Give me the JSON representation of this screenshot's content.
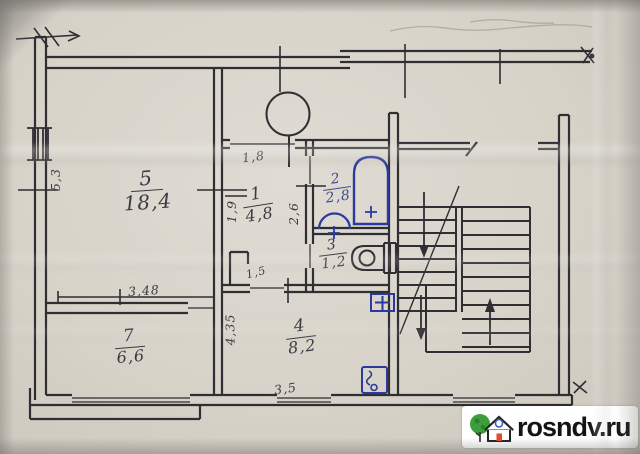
{
  "plan_title": "apartment floor plan (hand-drawn)",
  "rooms": [
    {
      "id": "living",
      "num": "5",
      "area": "18,4"
    },
    {
      "id": "hall",
      "num": "1",
      "area": "4,8"
    },
    {
      "id": "bath",
      "num": "2",
      "area": "2,8"
    },
    {
      "id": "wc",
      "num": "3",
      "area": "1,2"
    },
    {
      "id": "kitchen",
      "num": "4",
      "area": "8,2"
    },
    {
      "id": "bedroom",
      "num": "7",
      "area": "6,6"
    }
  ],
  "dims": [
    {
      "id": "left-height",
      "text": "5,3"
    },
    {
      "id": "bedroom-width",
      "text": "3,48"
    },
    {
      "id": "hall-door",
      "text": "1,8"
    },
    {
      "id": "hall-width",
      "text": "1,9"
    },
    {
      "id": "hall-depth",
      "text": "2,6"
    },
    {
      "id": "closet-width",
      "text": "1,5"
    },
    {
      "id": "kitchen-height",
      "text": "4,35"
    },
    {
      "id": "kitchen-width",
      "text": "3,5"
    }
  ],
  "watermark": {
    "text": "rosndv.ru"
  },
  "icons": {
    "bathtub": "bathtub-icon",
    "sink": "sink-icon",
    "toilet": "toilet-icon",
    "vent": "vent-shaft-icon",
    "stove": "electric-stove-icon",
    "cross_box": "plus-box-icon",
    "stairs": "staircase",
    "watermark_logo": "house-logo-icon"
  },
  "colors": {
    "paper": "#d7d3c9",
    "ink": "#2e2e33",
    "blue_ink": "#2b3a9b",
    "pencil": "#908d85",
    "watermark_bg": "#ffffff",
    "watermark_text": "#141414",
    "logo_tree": "#3d9e3d",
    "logo_door": "#e2492f",
    "logo_window": "#3f59c6"
  }
}
